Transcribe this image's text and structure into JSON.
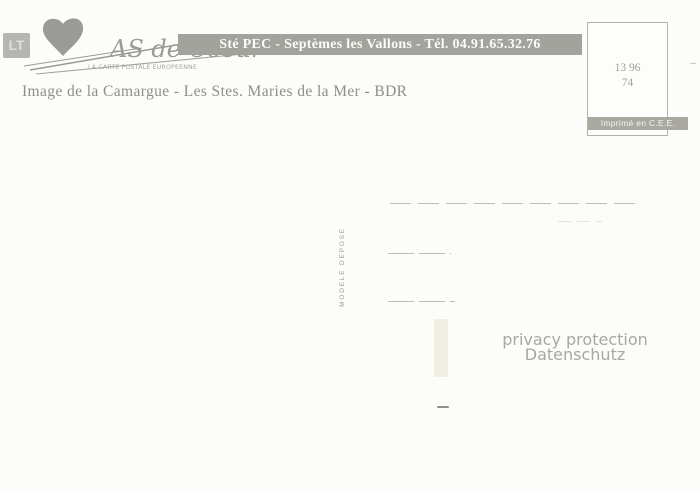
{
  "colors": {
    "banner_bg": "#a3a39e",
    "banner_text": "#fbfbf7",
    "logo_gray": "#9a9a96",
    "caption_text": "#8e8e89",
    "printed_label_bg": "#a9a9a1",
    "watermark_text": "#a7a7a5",
    "paper_bg": "#fcfcfa"
  },
  "corner_badge": {
    "label": "LT"
  },
  "logo": {
    "script_text": "AS de Coeur",
    "tagline": "LA CARTE POSTALE EUROPEENNE"
  },
  "banner": {
    "text": "Sté PEC - Septèmes les Vallons - Tél. 04.91.65.32.76"
  },
  "caption": {
    "text": "Image de la Camargue - Les Stes. Maries de la Mer - BDR"
  },
  "stamp_box": {
    "code_line1": "13 96",
    "code_line2": "74"
  },
  "printed_label": {
    "text": "Imprimé en C.E.E."
  },
  "model_note": {
    "text": "MODELE DEPOSE"
  },
  "watermark": {
    "line1": "privacy protection",
    "line2": "Datenschutz"
  }
}
